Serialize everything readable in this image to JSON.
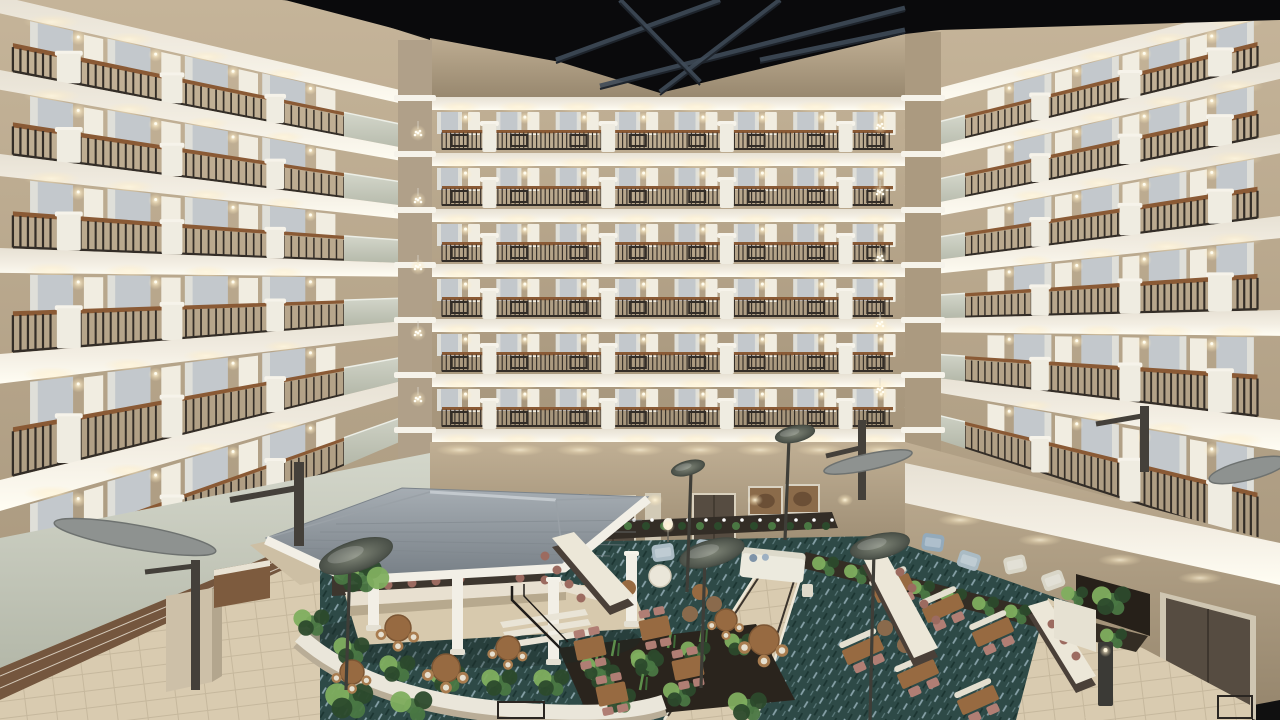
{
  "scene": {
    "type": "photograph",
    "subject": "hotel-atrium-interior",
    "view": "elevated interior view of a multi-story hotel atrium with balcony floors surrounding a lobby courtyard",
    "objects": [
      "dark-exposed-ceiling",
      "steel-roof-trusses",
      "balcony-floors",
      "metal-railings-with-diamond-motif",
      "wood-railing-caps",
      "white-stucco-pilasters",
      "guestroom-doors",
      "curtained-windows",
      "wall-sconces",
      "corner-pendant-chandeliers",
      "stepped-corner-parapets",
      "gazebo-bar",
      "gray-shingle-gazebo-roof",
      "white-columns",
      "bar-counter",
      "bar-stools",
      "lounge-sofa",
      "armchairs",
      "coffee-tables",
      "communal-high-tables",
      "round-dining-tables",
      "square-dining-tables",
      "dining-chairs",
      "curved-planter-wall",
      "tropical-plants",
      "peace-lily-planter",
      "fern-planter-rows",
      "patterned-teal-carpet",
      "tile-walkway",
      "ramp-with-railing",
      "leaf-disc-lamp-posts",
      "wing-light-fixtures",
      "bronze-bracket-arms",
      "wall-clock",
      "framed-artwork",
      "dark-double-doors",
      "bollard-light",
      "credenza",
      "column-pillar"
    ]
  },
  "palette": {
    "ceiling": "#0a0a0c",
    "truss": "#3f4b58",
    "trussDark": "#1e242c",
    "fascia": "#e7e1d4",
    "fasciaLight": "#fffdf3",
    "wallTan": "#c0af94",
    "wallTanDark": "#a08f74",
    "wallSage": "#cdd1c4",
    "wallSageDark": "#b4b8a9",
    "railDark": "#332d27",
    "railWood": "#8a5a35",
    "pilaster": "#efece1",
    "pilasterCap": "#f6f3ea",
    "doorWhite": "#f1ede1",
    "glass": "#c3c8cc",
    "curtain": "#e2e1da",
    "tile": "#d9cbb0",
    "tileLine": "#c6b89d",
    "carpet": "#2e4a47",
    "carpetLight": "#87a1a8",
    "carpetDark": "#1c3532",
    "roof": "#8f979d",
    "roofLight": "#c3c9ce",
    "roofDark": "#777f86",
    "wood": "#976a41",
    "woodLight": "#a87c4f",
    "mauve": "#b07e74",
    "mauveDark": "#9c6b60",
    "bench": "#e4dfd0",
    "sofa": "#eceade",
    "grayChair": "#aabbc4",
    "blueChair": "#93aabb",
    "cream": "#d9d6c8",
    "plant": "#4a7743",
    "plantDark": "#2c4a2c",
    "plantLight": "#7fae5f",
    "soil": "#2a241d",
    "lampDisc": "#5f665e",
    "wingGray": "#8e9290",
    "bronze": "#44403a",
    "glow": "#fff6dd",
    "doorBrown": "#564c41",
    "clockFace": "#f5f2ea",
    "frameWood": "#8b6b4a"
  },
  "structure": {
    "canvas": {
      "w": 1280,
      "h": 720
    },
    "floors_visible": 7,
    "backWall": {
      "x0": 430,
      "x1": 905,
      "floorTops": [
        97,
        153,
        209,
        264,
        319,
        374,
        429
      ],
      "groundTop": 442,
      "segments": 8
    },
    "leftWall": {
      "edgeX": 0,
      "backX": 430,
      "edgeTops": [
        -4,
        70,
        154,
        248,
        354,
        480,
        612
      ],
      "backTops": [
        97,
        153,
        209,
        264,
        319,
        374,
        429
      ],
      "railSpan": [
        0.03,
        0.8
      ],
      "parapetSpan": [
        0.8,
        1.0
      ]
    },
    "rightWall": {
      "edgeX": 1280,
      "backX": 905,
      "edgeTops": [
        -2,
        62,
        134,
        216,
        310,
        420,
        550
      ],
      "backTops": [
        97,
        153,
        209,
        264,
        319,
        374,
        429
      ],
      "railSpan": [
        0.06,
        0.84
      ],
      "parapetSpan": [
        0.84,
        1.0
      ]
    },
    "ceiling": {
      "poly": [
        [
          285,
          0
        ],
        [
          1280,
          0
        ],
        [
          1280,
          20
        ],
        [
          940,
          30
        ],
        [
          905,
          34
        ],
        [
          660,
          93
        ],
        [
          560,
          62
        ],
        [
          430,
          38
        ]
      ],
      "trusses": [
        [
          556,
          60,
          720,
          0
        ],
        [
          600,
          86,
          905,
          8
        ],
        [
          660,
          92,
          780,
          0
        ],
        [
          700,
          82,
          620,
          0
        ],
        [
          760,
          60,
          905,
          30
        ]
      ]
    },
    "chandeliers": {
      "left": {
        "x": 418,
        "ys": [
          133,
          200,
          267,
          333,
          399
        ]
      },
      "right": {
        "x": 880,
        "ys": [
          126,
          192,
          258,
          324,
          390
        ]
      }
    },
    "clock": {
      "cx": 926,
      "cy": 506,
      "r": 10
    },
    "artworks": [
      [
        750,
        488,
        31,
        26
      ],
      [
        787,
        486,
        31,
        26
      ]
    ],
    "backDoors": [
      [
        592,
        497,
        42,
        52
      ],
      [
        694,
        495,
        40,
        50
      ]
    ],
    "groundSconceXs": [
      470,
      520,
      575,
      655,
      755,
      845
    ],
    "lamps": [
      {
        "cx": 356,
        "cy": 556,
        "rx": 38,
        "ry": 15,
        "rot": -18,
        "px": 350,
        "py": 690
      },
      {
        "cx": 712,
        "cy": 553,
        "rx": 33,
        "ry": 13,
        "rot": -15,
        "px": 705,
        "py": 688
      },
      {
        "cx": 880,
        "cy": 546,
        "rx": 30,
        "ry": 12,
        "rot": -12,
        "px": 874,
        "py": 720
      },
      {
        "cx": 688,
        "cy": 468,
        "rx": 17,
        "ry": 7,
        "rot": -15,
        "px": 691,
        "py": 592
      },
      {
        "cx": 795,
        "cy": 434,
        "rx": 20,
        "ry": 8,
        "rot": -12,
        "px": 789,
        "py": 540
      }
    ],
    "wings": [
      {
        "cx": 135,
        "cy": 537,
        "rx": 82,
        "ry": 12,
        "rot": 10
      },
      {
        "cx": 868,
        "cy": 462,
        "rx": 45,
        "ry": 8,
        "rot": -12
      },
      {
        "cx": 1248,
        "cy": 470,
        "rx": 40,
        "ry": 10,
        "rot": -14
      }
    ],
    "bollard": {
      "x": 1098,
      "y": 642,
      "w": 15,
      "h": 64
    }
  },
  "furniture": {
    "roundTables": [
      [
        398,
        628,
        13
      ],
      [
        446,
        668,
        14
      ],
      [
        352,
        672,
        12
      ],
      [
        508,
        648,
        12
      ],
      [
        764,
        640,
        15
      ],
      [
        726,
        620,
        11
      ]
    ],
    "squareTables": [
      [
        590,
        648
      ],
      [
        655,
        628
      ],
      [
        612,
        694
      ],
      [
        688,
        668
      ]
    ],
    "diningSets": [
      [
        893,
        588
      ],
      [
        943,
        608
      ],
      [
        993,
        632
      ],
      [
        863,
        650
      ],
      [
        918,
        674
      ],
      [
        978,
        700
      ]
    ],
    "longCounters": [
      {
        "top": [
          [
            552,
            538
          ],
          [
            574,
            532
          ],
          [
            634,
            596
          ],
          [
            610,
            606
          ]
        ],
        "stools": [
          [
            545,
            556
          ],
          [
            557,
            570
          ],
          [
            569,
            584
          ],
          [
            581,
            598
          ]
        ]
      },
      {
        "top": [
          [
            862,
            556
          ],
          [
            884,
            550
          ],
          [
            938,
            648
          ],
          [
            914,
            658
          ]
        ],
        "stools": [
          [
            900,
            572
          ],
          [
            912,
            588
          ],
          [
            924,
            604
          ],
          [
            936,
            620
          ]
        ]
      },
      {
        "top": [
          [
            1028,
            606
          ],
          [
            1048,
            600
          ],
          [
            1096,
            676
          ],
          [
            1076,
            684
          ]
        ],
        "stools": [
          [
            1052,
            624
          ],
          [
            1064,
            640
          ],
          [
            1076,
            656
          ]
        ]
      }
    ],
    "armchairs": [
      {
        "x": 652,
        "y": 544,
        "c": "grayChair",
        "rot": -8
      },
      {
        "x": 696,
        "y": 540,
        "c": "grayChair",
        "rot": 6
      },
      {
        "x": 872,
        "y": 540,
        "c": "blueChair",
        "rot": -6
      },
      {
        "x": 922,
        "y": 534,
        "c": "blueChair",
        "rot": 8
      },
      {
        "x": 958,
        "y": 552,
        "c": "grayChair",
        "rot": 18
      },
      {
        "x": 1004,
        "y": 556,
        "c": "cream",
        "rot": -12
      },
      {
        "x": 1042,
        "y": 572,
        "c": "cream",
        "rot": -20
      }
    ],
    "sofa": {
      "x": 740,
      "y": 556,
      "w": 64,
      "h": 30,
      "rot": 6
    },
    "plantClusters": [
      {
        "x": 360,
        "y": 575,
        "r": 15,
        "n": 8
      },
      {
        "x": 312,
        "y": 622,
        "r": 12,
        "n": 5
      },
      {
        "x": 352,
        "y": 650,
        "r": 12,
        "n": 5
      },
      {
        "x": 398,
        "y": 668,
        "r": 12,
        "n": 5
      },
      {
        "x": 448,
        "y": 678,
        "r": 12,
        "n": 5
      },
      {
        "x": 500,
        "y": 682,
        "r": 12,
        "n": 5
      },
      {
        "x": 552,
        "y": 682,
        "r": 12,
        "n": 5
      },
      {
        "x": 604,
        "y": 676,
        "r": 11,
        "n": 5
      },
      {
        "x": 648,
        "y": 664,
        "r": 11,
        "n": 5
      },
      {
        "x": 596,
        "y": 668,
        "r": 10,
        "n": 5
      },
      {
        "x": 646,
        "y": 660,
        "r": 10,
        "n": 5
      },
      {
        "x": 696,
        "y": 652,
        "r": 10,
        "n": 5
      },
      {
        "x": 740,
        "y": 644,
        "r": 10,
        "n": 5
      },
      {
        "x": 620,
        "y": 700,
        "r": 11,
        "n": 5
      },
      {
        "x": 680,
        "y": 694,
        "r": 11,
        "n": 5
      },
      {
        "x": 826,
        "y": 566,
        "r": 9,
        "n": 4
      },
      {
        "x": 858,
        "y": 574,
        "r": 9,
        "n": 4
      },
      {
        "x": 890,
        "y": 582,
        "r": 9,
        "n": 4
      },
      {
        "x": 922,
        "y": 590,
        "r": 9,
        "n": 4
      },
      {
        "x": 954,
        "y": 598,
        "r": 9,
        "n": 4
      },
      {
        "x": 986,
        "y": 606,
        "r": 9,
        "n": 4
      },
      {
        "x": 1018,
        "y": 614,
        "r": 9,
        "n": 4
      },
      {
        "x": 1050,
        "y": 622,
        "r": 9,
        "n": 4
      },
      {
        "x": 1082,
        "y": 630,
        "r": 9,
        "n": 4
      },
      {
        "x": 1114,
        "y": 638,
        "r": 9,
        "n": 4
      },
      {
        "x": 1112,
        "y": 600,
        "r": 13,
        "n": 5
      },
      {
        "x": 1075,
        "y": 596,
        "r": 9,
        "n": 4
      },
      {
        "x": 350,
        "y": 700,
        "r": 16,
        "n": 5
      },
      {
        "x": 412,
        "y": 706,
        "r": 14,
        "n": 4
      },
      {
        "x": 748,
        "y": 706,
        "r": 13,
        "n": 5
      }
    ]
  }
}
